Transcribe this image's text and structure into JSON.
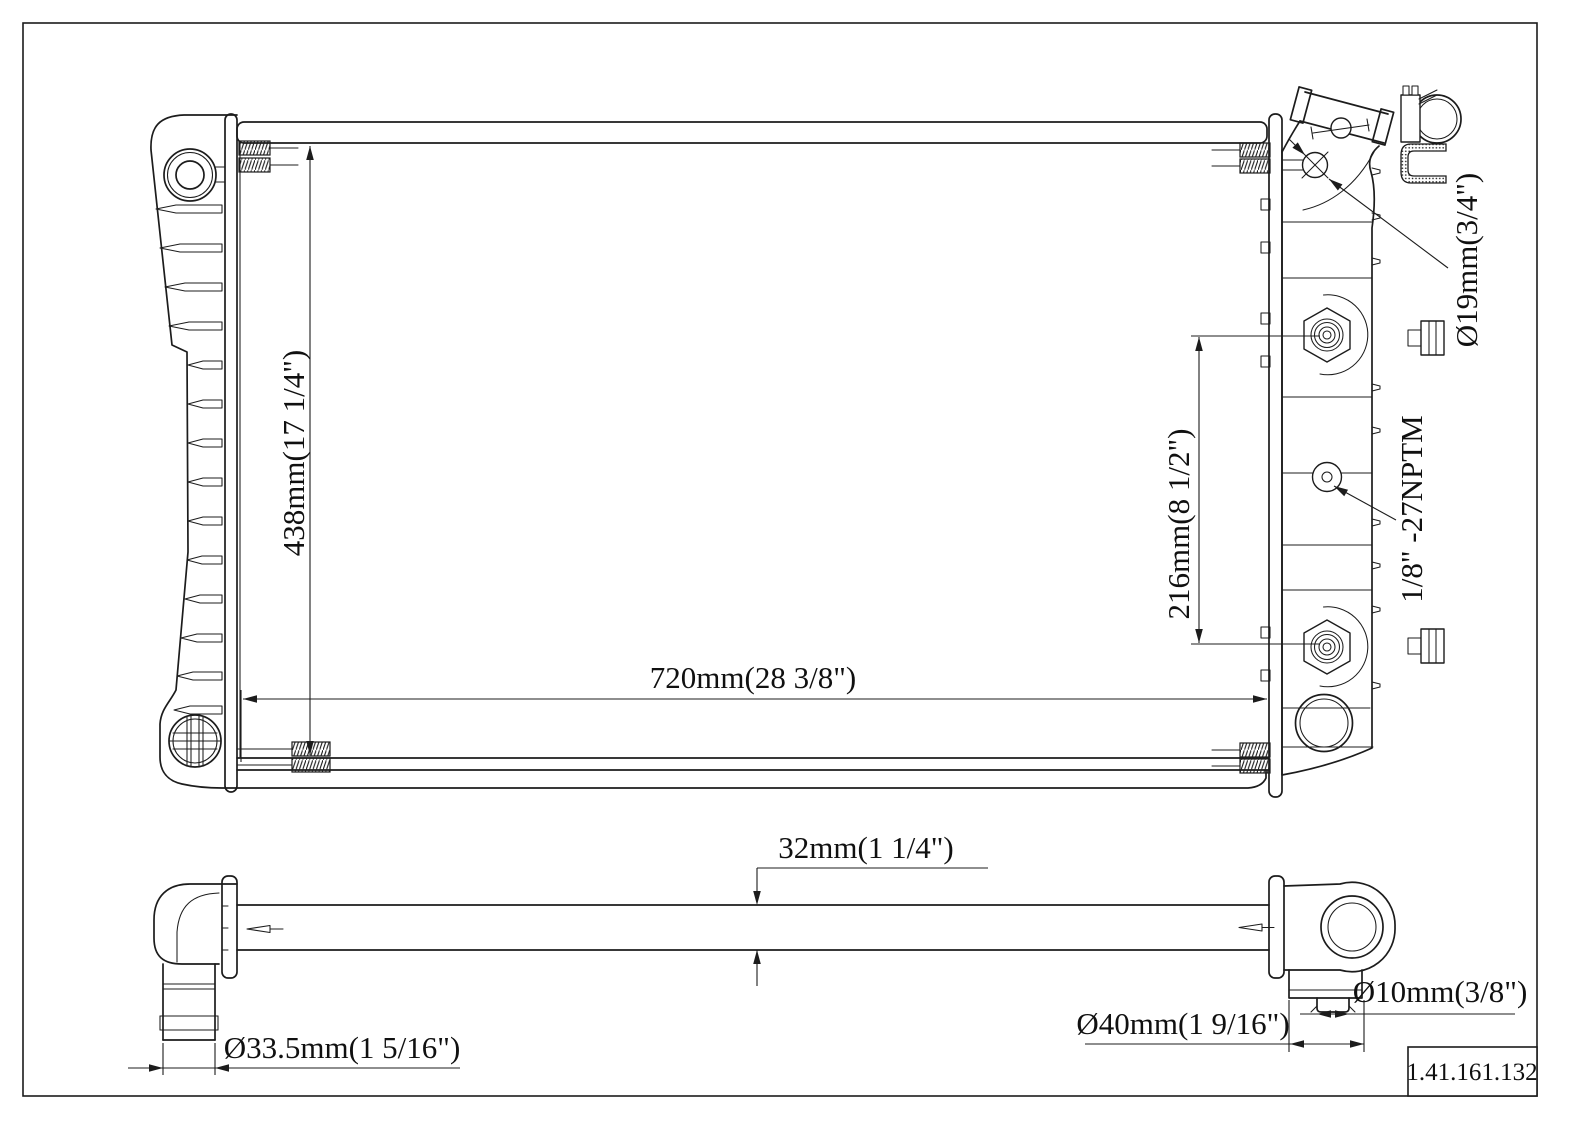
{
  "title": "Radiator engineering drawing",
  "labels": {
    "overall_height": "438mm(17 1/4\")",
    "core_width": "720mm(28 3/8\")",
    "fitting_spacing": "216mm(8 1/2\")",
    "inlet_diameter": "Ø19mm(3/4\")",
    "oil_cooler_thread": "1/8\" -27NPTM",
    "core_thickness": "32mm(1 1/4\")",
    "outlet_hose_diameter": "Ø33.5mm(1 5/16\")",
    "inlet_hose_diameter": "Ø40mm(1 9/16\")",
    "drain_diameter": "Ø10mm(3/8\")"
  },
  "part_number": "1.41.161.132",
  "colors": {
    "line": "#1c1c1c",
    "background": "#ffffff"
  }
}
